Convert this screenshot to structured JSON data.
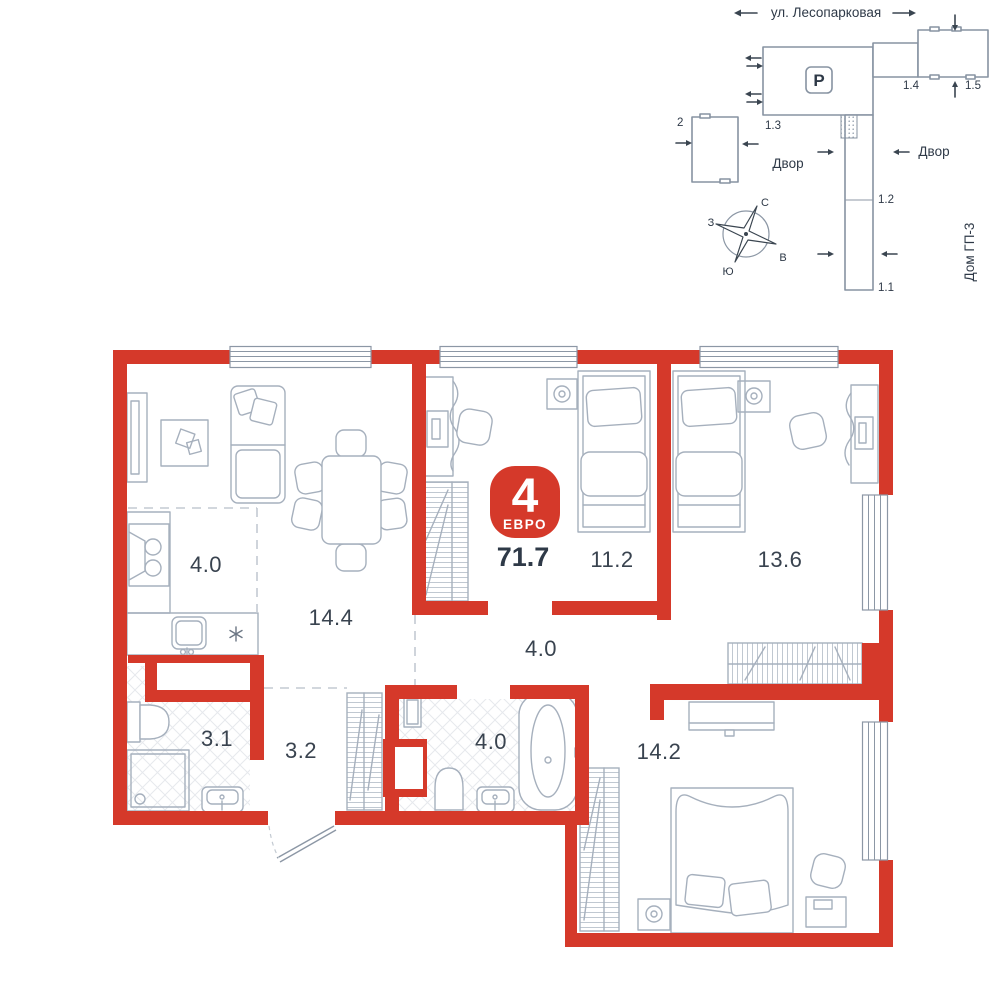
{
  "badge": {
    "rooms_number": "4",
    "type_label": "ЕВРО",
    "total_area": "71.7",
    "color": "#d5392a"
  },
  "rooms": [
    {
      "name": "kitchen",
      "area": "4.0"
    },
    {
      "name": "living-dining",
      "area": "14.4"
    },
    {
      "name": "bedroom-1",
      "area": "11.2"
    },
    {
      "name": "bedroom-2",
      "area": "13.6"
    },
    {
      "name": "corridor",
      "area": "4.0"
    },
    {
      "name": "bathroom-1",
      "area": "3.1"
    },
    {
      "name": "entry-hall",
      "area": "3.2"
    },
    {
      "name": "bathroom-2",
      "area": "4.0"
    },
    {
      "name": "bedroom-3",
      "area": "14.2"
    }
  ],
  "site_plan": {
    "street": "ул. Лесопарковая",
    "parking": "P",
    "yard_left": "Двор",
    "yard_right": "Двор",
    "house": "Дом ГП-3",
    "sections": {
      "s11": "1.1",
      "s12": "1.2",
      "s13": "1.3",
      "s14": "1.4",
      "s15": "1.5",
      "b2": "2"
    },
    "compass": {
      "n": "С",
      "e": "В",
      "s": "Ю",
      "w": "З"
    }
  },
  "colors": {
    "wall": "#d5392a",
    "outline": "#a6b0bd",
    "text": "#39434f"
  }
}
